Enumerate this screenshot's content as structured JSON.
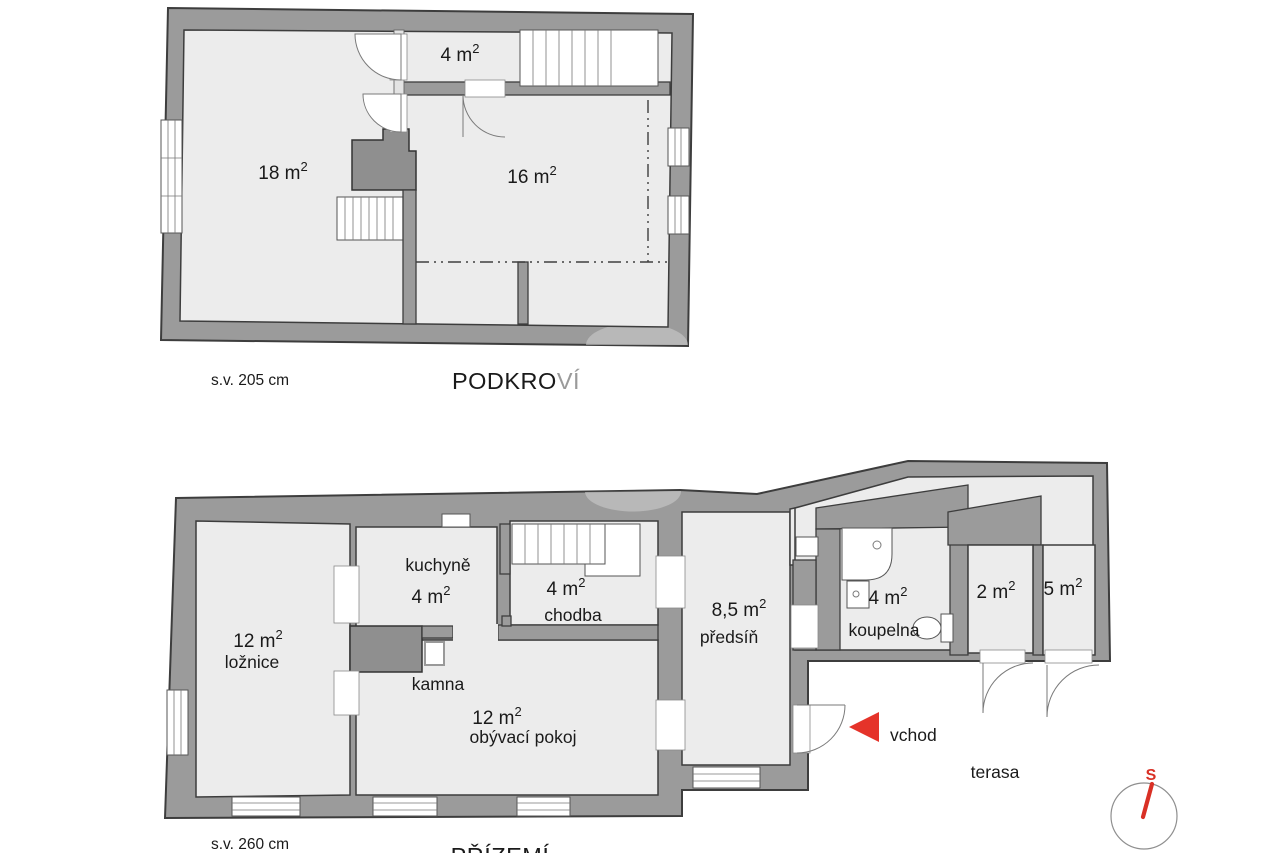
{
  "colors": {
    "wall": "#9b9b9b",
    "room_fill": "#ececec",
    "outline": "#3d3d3d",
    "accent_red": "#e5332a",
    "compass_red": "#d93025",
    "background": "#ffffff"
  },
  "attic": {
    "title_primary": "PODKRO",
    "title_secondary": "VÍ",
    "ceiling_note": "s.v. 205 cm",
    "rooms": [
      {
        "id": "attic-room-left",
        "area": "18 m",
        "sup": "2"
      },
      {
        "id": "attic-room-right",
        "area": "16 m",
        "sup": "2"
      },
      {
        "id": "attic-room-top",
        "area": "4 m",
        "sup": "2"
      }
    ]
  },
  "ground": {
    "title": "PŘÍZEMÍ",
    "ceiling_note": "s.v.  260 cm",
    "rooms": [
      {
        "id": "bedroom",
        "area": "12 m",
        "sup": "2",
        "name": "ložnice"
      },
      {
        "id": "kitchen",
        "area": "4 m",
        "sup": "2",
        "name": "kuchyně"
      },
      {
        "id": "hallway",
        "area": "4 m",
        "sup": "2",
        "name": "chodba"
      },
      {
        "id": "living-room",
        "area": "12 m",
        "sup": "2",
        "name": "obývací pokoj"
      },
      {
        "id": "entry-hall",
        "area": "8,5 m",
        "sup": "2",
        "name": "předsíň"
      },
      {
        "id": "bathroom",
        "area": "4 m",
        "sup": "2",
        "name": "koupelna"
      },
      {
        "id": "closet-2",
        "area": "2 m",
        "sup": "2"
      },
      {
        "id": "closet-5",
        "area": "5 m",
        "sup": "2"
      }
    ],
    "annotations": {
      "stove": "kamna",
      "entrance": "vchod",
      "terrace": "terasa"
    },
    "compass": {
      "north_label": "S"
    }
  }
}
